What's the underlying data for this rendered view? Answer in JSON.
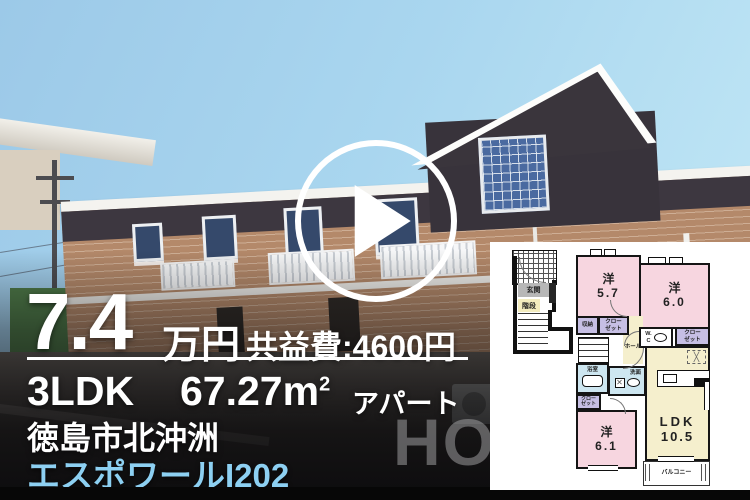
{
  "listing": {
    "price_value": "7.4",
    "price_unit": "万円",
    "fee": "共益費:4600円",
    "layout": "3LDK",
    "area": "67.27m",
    "area_sup": "2",
    "building_type": "アパート",
    "address": "徳島市北沖洲",
    "name": "エスポワールI202"
  },
  "watermark": {
    "text": "HO"
  },
  "icons": {
    "play_button": "triangle-right"
  },
  "palette": {
    "name-accent": "#8dd0f2",
    "room-pink": "#f7d6e0",
    "ldk-cream": "#f5efcd",
    "closet-purple": "#c6bfe4",
    "wet-blue": "#cde6f0"
  },
  "floorplan": {
    "entrance": {
      "genkan": "玄関",
      "kaidan": "階段"
    },
    "rooms": {
      "west_label": "洋",
      "west1_size": "5.7",
      "west2_size": "6.0",
      "west3_size": "6.1",
      "ldk_label": "LDK",
      "ldk_size": "10.5",
      "storage": "収納",
      "closet_l1": "クロー",
      "closet_l2": "ゼット",
      "wc_l1": "W.",
      "wc_l2": "C",
      "hall": "ホール",
      "bath": "浴室",
      "wash": "洗面",
      "balcony": "バルコニー",
      "cross": "╳"
    }
  }
}
